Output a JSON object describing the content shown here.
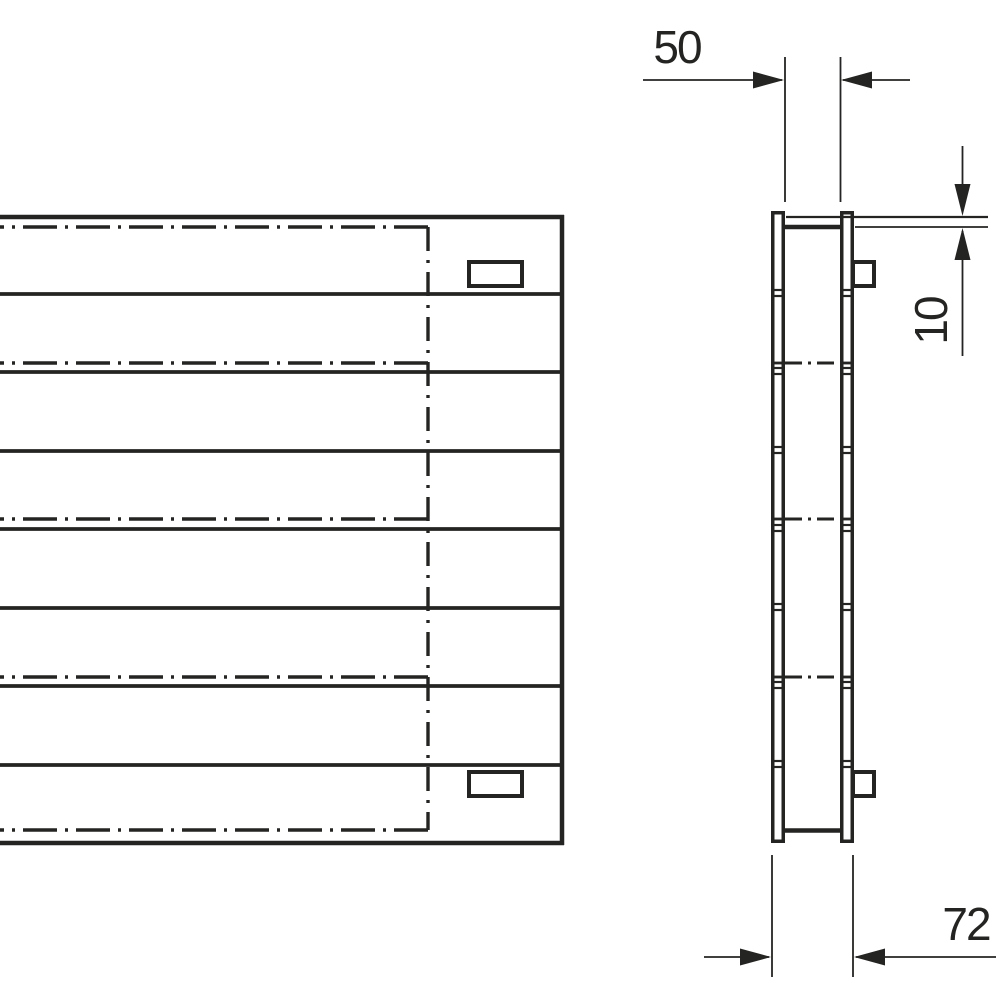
{
  "drawing": {
    "dimensions": {
      "width_label": "50",
      "offset_label": "10",
      "depth_label": "72"
    },
    "front_view": {
      "panel_rows": 8,
      "center_lines": 5,
      "mounting_brackets": 2
    },
    "side_view": {
      "tube_columns": 2,
      "center_lines": 3,
      "mounting_brackets": 2
    },
    "colors": {
      "background": "#ffffff",
      "line": "#242422"
    }
  }
}
